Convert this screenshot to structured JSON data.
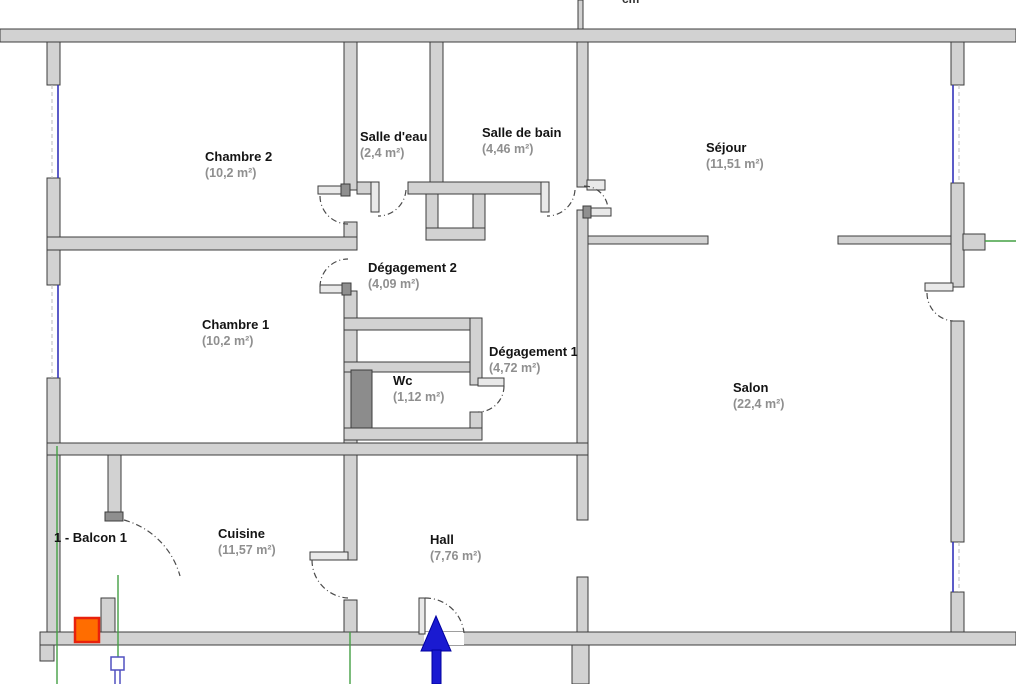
{
  "plan": {
    "unit_label": "cm",
    "balcony_label": "1 - Balcon 1",
    "rooms": [
      {
        "name": "Chambre 2",
        "area": "(10,2 m²)"
      },
      {
        "name": "Salle d'eau",
        "area": "(2,4 m²)"
      },
      {
        "name": "Salle de bain",
        "area": "(4,46 m²)"
      },
      {
        "name": "Séjour",
        "area": "(11,51 m²)"
      },
      {
        "name": "Dégagement 2",
        "area": "(4,09 m²)"
      },
      {
        "name": "Chambre 1",
        "area": "(10,2 m²)"
      },
      {
        "name": "Dégagement 1",
        "area": "(4,72 m²)"
      },
      {
        "name": "Wc",
        "area": "(1,12 m²)"
      },
      {
        "name": "Salon",
        "area": "(22,4 m²)"
      },
      {
        "name": "Cuisine",
        "area": "(11,57 m²)"
      },
      {
        "name": "Hall",
        "area": "(7,76 m²)"
      }
    ],
    "colors": {
      "wall_fill": "#d2d2d2",
      "wall_stroke": "#3c3c3c",
      "guide_green": "#44a044",
      "arrow_blue": "#1a1ad1",
      "selection_orange": "#ff6d00",
      "selection_border": "#e8210c",
      "window_blue": "#3333bb",
      "area_text_gray": "#8f8f8f"
    },
    "symbols": [
      "entrance-arrow-icon",
      "selected-object-square",
      "radiator-symbol",
      "door-swing-arc",
      "window-symbol",
      "guide-line"
    ]
  }
}
